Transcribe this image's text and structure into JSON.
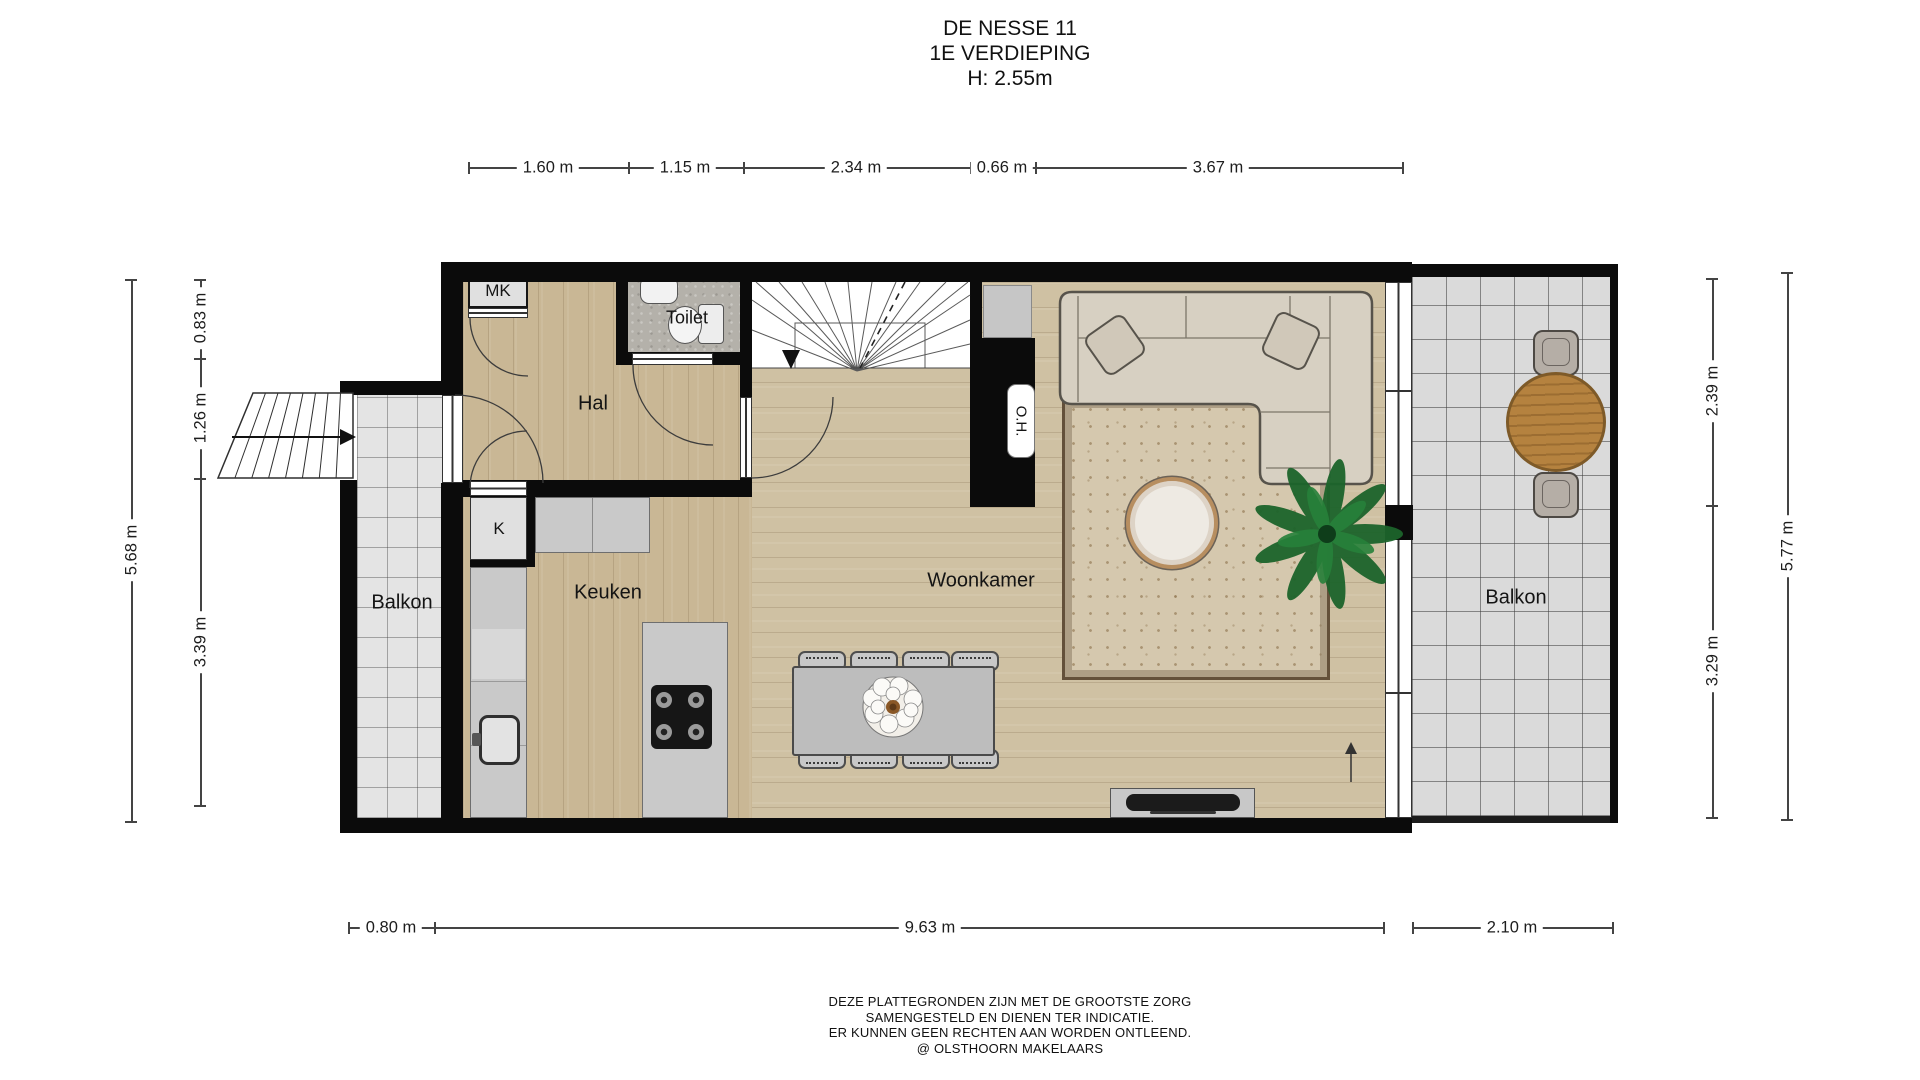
{
  "title": {
    "address": "DE NESSE 11",
    "floor": "1E VERDIEPING",
    "height": "H: 2.55m"
  },
  "rooms": {
    "hal": "Hal",
    "toilet": "Toilet",
    "keuken": "Keuken",
    "woonkamer": "Woonkamer",
    "balkon_left": "Balkon",
    "balkon_right": "Balkon",
    "mk_closet": "MK",
    "k_closet": "K",
    "oh_unit": "O.H."
  },
  "dims": {
    "top": [
      "1.60 m",
      "1.15 m",
      "2.34 m",
      "0.66 m",
      "3.67 m"
    ],
    "bottom_left": "0.80 m",
    "bottom_main": "9.63 m",
    "bottom_right": "2.10 m",
    "left_outer": "5.68 m",
    "left_inner": [
      "0.83 m",
      "1.26 m",
      "3.39 m"
    ],
    "right_inner": [
      "2.39 m",
      "3.29 m"
    ],
    "right_outer": "5.77 m"
  },
  "footer": {
    "line1": "DEZE PLATTEGRONDEN ZIJN MET DE GROOTSTE ZORG",
    "line2": "SAMENGESTELD EN DIENEN TER INDICATIE.",
    "line3": "ER KUNNEN GEEN RECHTEN AAN WORDEN ONTLEEND.",
    "line4": "@ OLSTHOORN MAKELAARS"
  },
  "colors": {
    "wall": "#0b0b0b",
    "wood_hall": "#c9b795",
    "wood_living": "#cfc1a3",
    "tile_left_balcony": "#e4e4e4",
    "tile_right_balcony": "#dadada",
    "toilet_floor": "#b4b1aa",
    "counter": "#c9c9c9",
    "sofa": "#d7d0c2",
    "rug": "#d5c8ae",
    "balcony_table_wood": "#b5823f",
    "plant": "#1c642b"
  }
}
